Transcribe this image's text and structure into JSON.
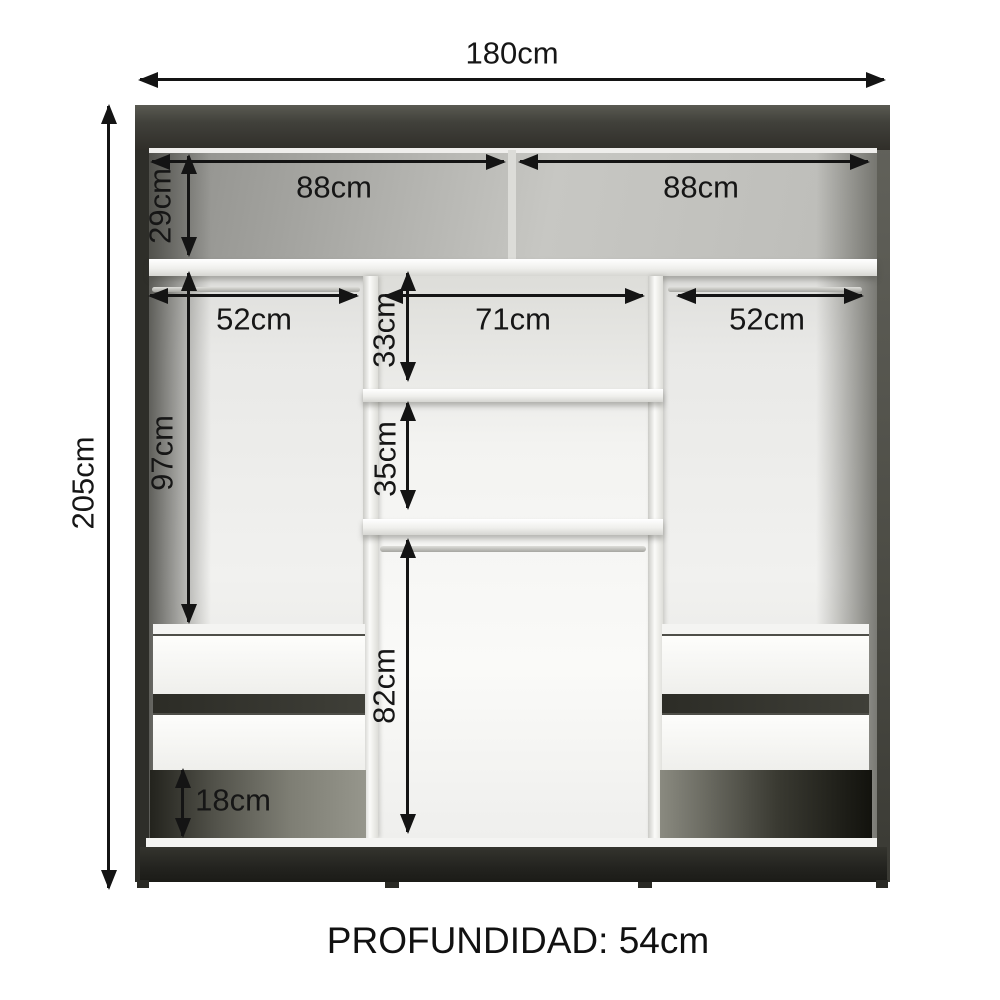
{
  "wardrobe": {
    "depth_label": "PROFUNDIDAD: 54cm",
    "overall": {
      "total_width": "180cm",
      "total_height": "205cm"
    },
    "sections": {
      "top_shelf_left_width": "88cm",
      "top_shelf_right_width": "88cm",
      "top_shelf_height": "29cm",
      "left_column_width": "52cm",
      "center_column_width": "71cm",
      "right_column_width": "52cm",
      "center_upper_cubby_height": "33cm",
      "center_middle_cubby_height": "35cm",
      "left_hanging_space_height": "97cm",
      "center_lower_space_height": "82cm",
      "base_gap_height": "18cm"
    },
    "colors": {
      "cabinet_dark": "#34342e",
      "base_black": "#23231f",
      "interior_gray": "#d9d9d5",
      "shelf_white": "#fafaf8",
      "dimension_text": "#161616"
    }
  }
}
